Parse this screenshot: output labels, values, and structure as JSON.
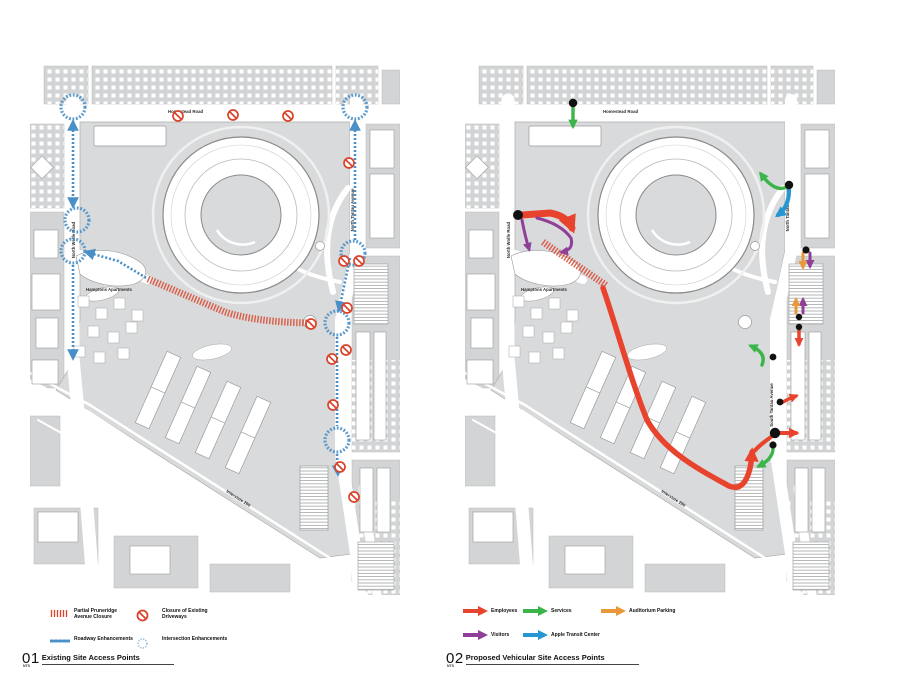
{
  "colors": {
    "map_gray": "#d9dadb",
    "block_gray": "#d3d4d5",
    "outline_gray": "#9a9b9c",
    "enhancement_blue": "#4a90c8",
    "closure_red": "#d9442b",
    "employees_red": "#e8432d",
    "services_green": "#3bb54a",
    "visitors_purple": "#8f3f97",
    "transit_blue": "#2596d1",
    "auditorium_orange": "#e8973b",
    "dot_black": "#111111"
  },
  "streets": {
    "homestead": "Homestead Road",
    "north_tantau": "North Tantau Avenue",
    "south_tantau": "South Tantau Avenue",
    "north_wolfe": "North Wolfe Road",
    "hamptons": "Hamptons Apartments",
    "interstate": "Interstate 280"
  },
  "left_panel": {
    "number": "01",
    "title": "Existing Site Access Points",
    "scale_note": "NTS",
    "legend": [
      {
        "id": "pruneridge-closure",
        "label": "Partial Pruneridge Avenue Closure"
      },
      {
        "id": "driveway-closure",
        "label": "Closure of Existing Driveways"
      },
      {
        "id": "roadway-enhancements",
        "label": "Roadway Enhancements"
      },
      {
        "id": "intersection-enhancements",
        "label": "Intersection Enhancements"
      }
    ]
  },
  "right_panel": {
    "number": "02",
    "title": "Proposed Vehicular Site Access Points",
    "scale_note": "NTS",
    "legend": [
      {
        "label": "Employees",
        "color": "#e8432d"
      },
      {
        "label": "Services",
        "color": "#3bb54a"
      },
      {
        "label": "Auditorium Parking",
        "color": "#e8973b"
      },
      {
        "label": "Visitors",
        "color": "#8f3f97"
      },
      {
        "label": "Apple Transit Center",
        "color": "#2596d1"
      }
    ]
  }
}
